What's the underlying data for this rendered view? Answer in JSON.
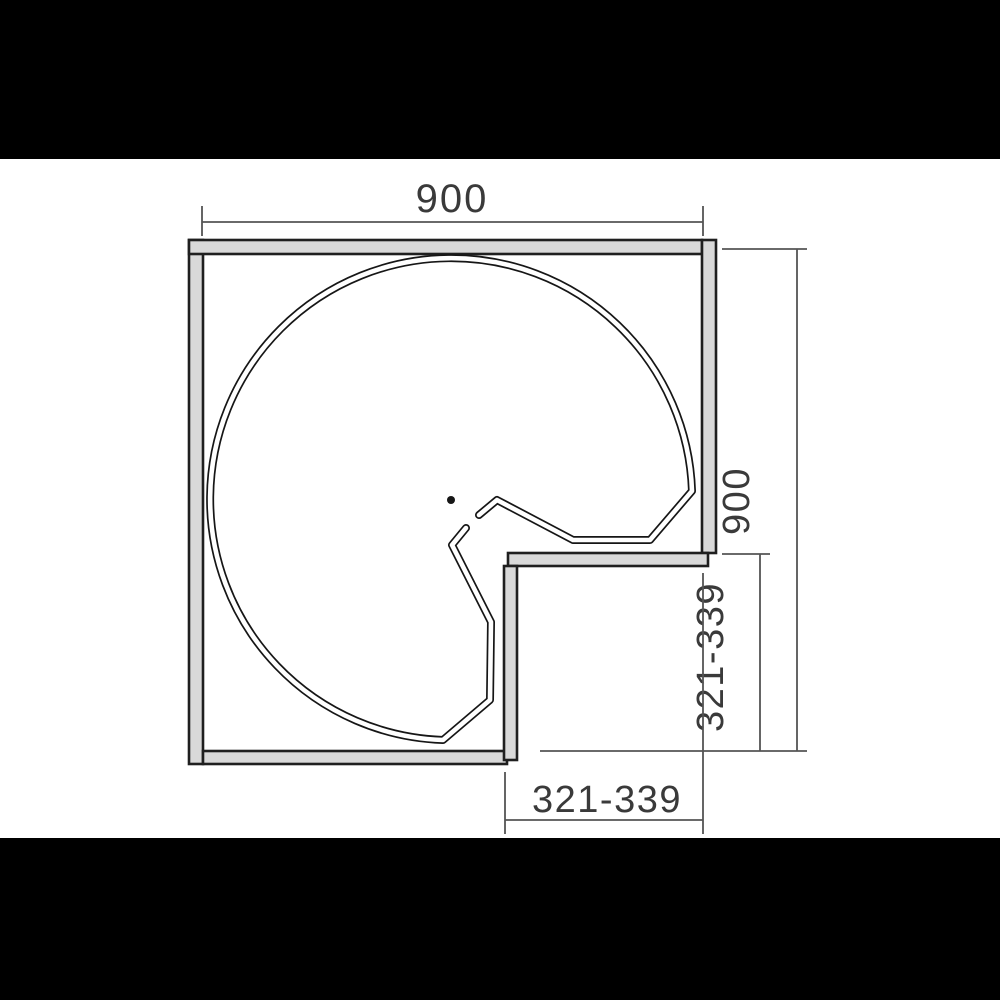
{
  "drawing": {
    "kind": "technical line drawing, top view",
    "subject": "kidney-shaped 3/4 carousel shelf inside an L-shaped corner cabinet"
  },
  "dimensions": {
    "cabinet_width": "900",
    "cabinet_depth": "900",
    "recess_depth": "321-339",
    "recess_width": "321-339"
  },
  "colors": {
    "letterbox": "#000000",
    "paper": "#ffffff",
    "wall_fill": "#d9d9d9",
    "outline": "#1f1f1f",
    "dimension_line": "#545454",
    "dimension_text": "#3a3a3a"
  }
}
